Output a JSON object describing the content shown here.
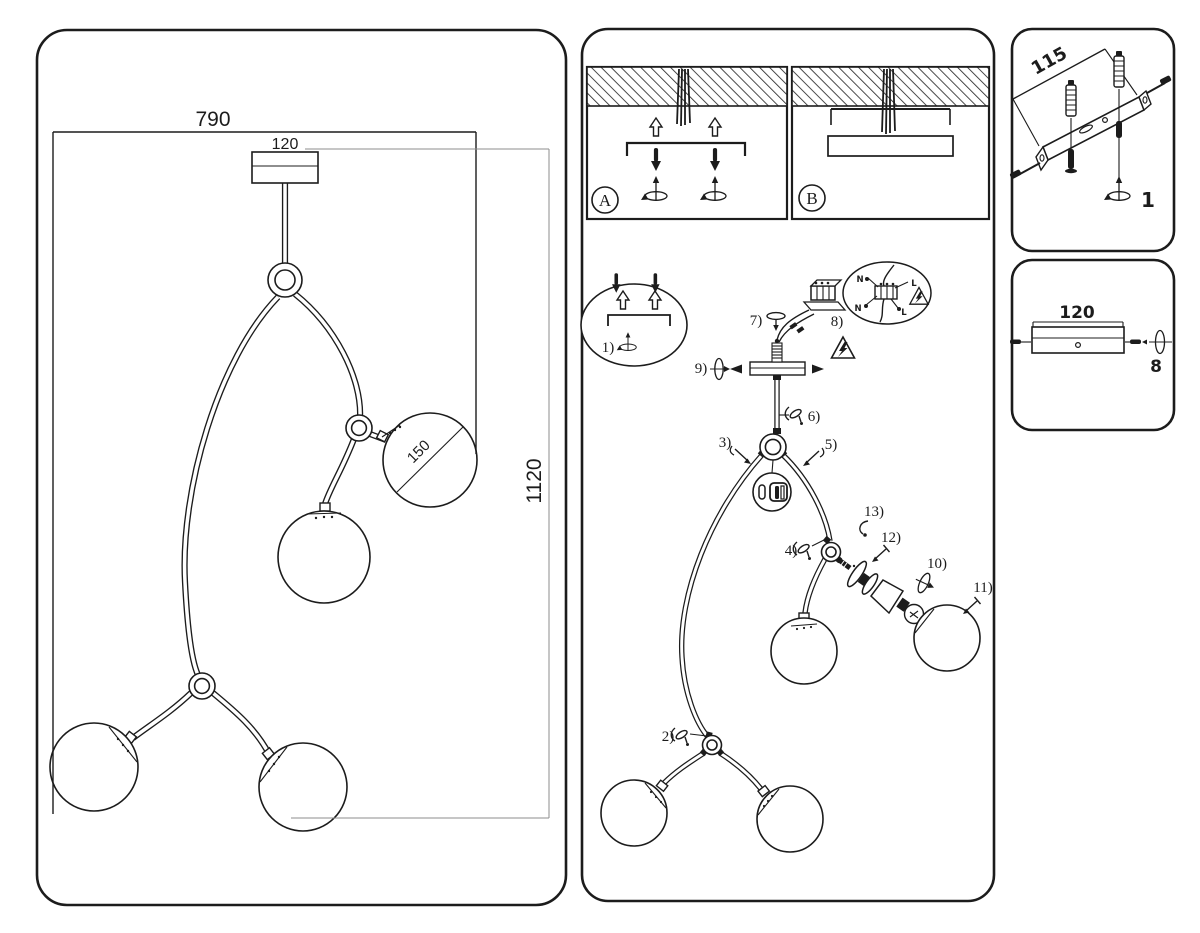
{
  "overview_panel": {
    "width_mm": "790",
    "canopy_width_mm": "120",
    "height_mm": "1120",
    "globe_diameter_mm": "150"
  },
  "ceiling_mount": {
    "panel_a_label": "A",
    "panel_b_label": "B"
  },
  "assembly": {
    "steps": {
      "s1": "1)",
      "s2": "2)",
      "s3": "3)",
      "s4": "4)",
      "s5": "5)",
      "s6": "6)",
      "s7": "7)",
      "s8": "8)",
      "s9": "9)",
      "s10": "10)",
      "s11": "11)",
      "s12": "12)",
      "s13": "13)"
    },
    "wiring": {
      "n_top": "N",
      "l_top": "L",
      "n_bottom": "N",
      "l_bottom": "L"
    }
  },
  "bracket_inset": {
    "length_mm": "115",
    "step_number": "1"
  },
  "canopy_inset": {
    "width_mm": "120",
    "step_number": "8"
  }
}
